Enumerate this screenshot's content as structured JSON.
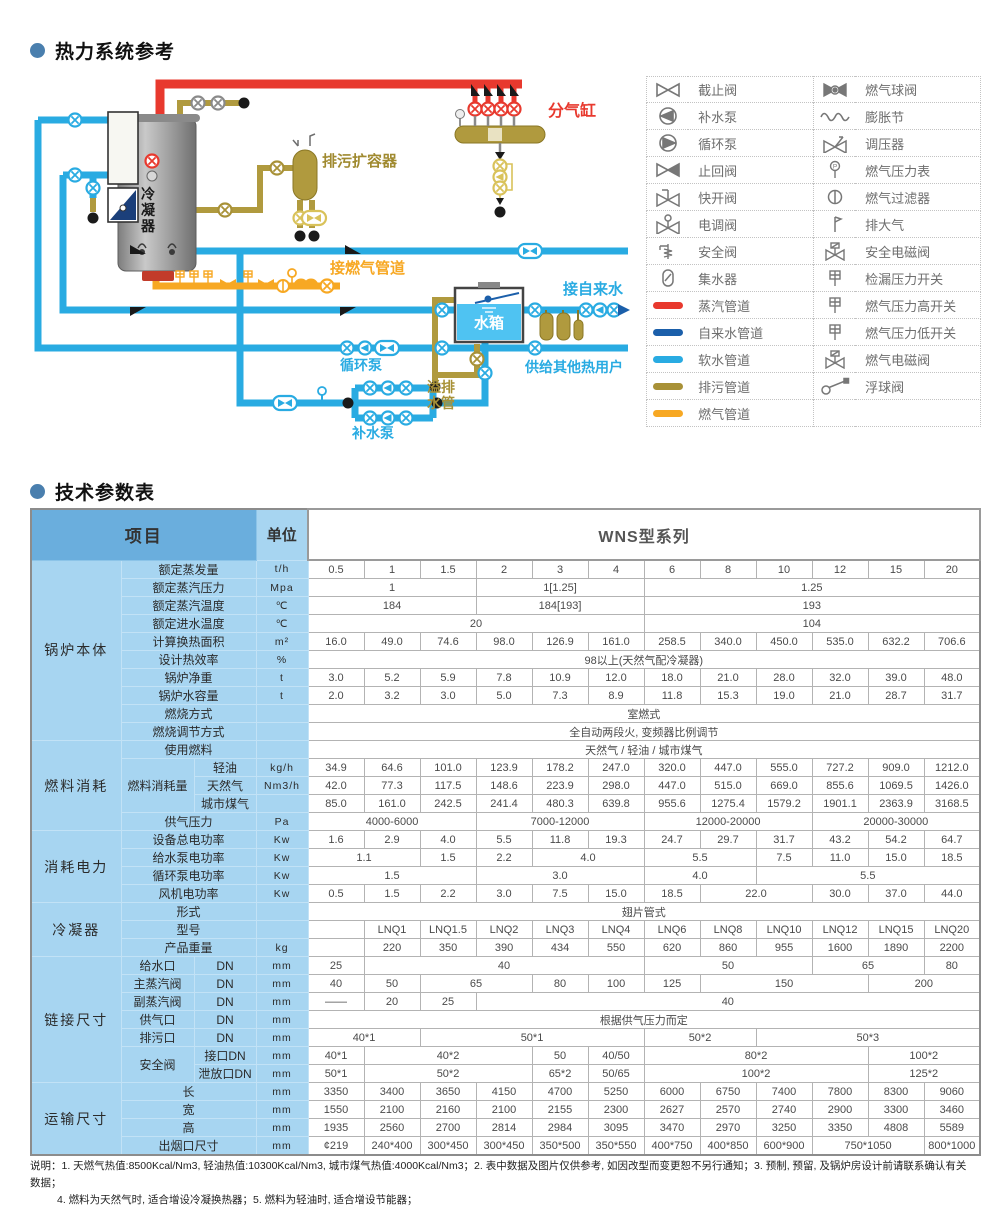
{
  "section_thermal": {
    "title": "热力系统参考"
  },
  "section_params": {
    "title": "技术参数表"
  },
  "diagram": {
    "labels": {
      "condenser": "冷凝器",
      "blowdown_vessel": "排污扩容器",
      "steam_header": "分气缸",
      "gas_pipe": "接燃气管道",
      "tap_water": "接自来水",
      "overflow_pipe": "溢排水管",
      "water_tank": "水箱",
      "circulation_pump": "循环泵",
      "makeup_pump": "补水泵",
      "other_users": "供给其他热用户"
    },
    "colors": {
      "steam": "#E8392E",
      "tap_water": "#1B5FAA",
      "soft_water": "#29ABE2",
      "blowdown": "#A89137",
      "gas": "#F7A823"
    }
  },
  "legend": {
    "left": [
      {
        "icon": "gate-valve",
        "label": "截止阀"
      },
      {
        "icon": "makeup-pump",
        "label": "补水泵"
      },
      {
        "icon": "circulation-pump",
        "label": "循环泵"
      },
      {
        "icon": "check-valve",
        "label": "止回阀"
      },
      {
        "icon": "quick-open-valve",
        "label": "快开阀"
      },
      {
        "icon": "electric-valve",
        "label": "电调阀"
      },
      {
        "icon": "safety-valve",
        "label": "安全阀"
      },
      {
        "icon": "water-collector",
        "label": "集水器"
      },
      {
        "icon": "steam-pipe",
        "label": "蒸汽管道",
        "color": "#E8392E"
      },
      {
        "icon": "tap-water-pipe",
        "label": "自来水管道",
        "color": "#1B5FAA"
      },
      {
        "icon": "soft-water-pipe",
        "label": "软水管道",
        "color": "#29ABE2"
      },
      {
        "icon": "blowdown-pipe",
        "label": "排污管道",
        "color": "#A89137"
      },
      {
        "icon": "gas-pipe",
        "label": "燃气管道",
        "color": "#F7A823"
      }
    ],
    "right": [
      {
        "icon": "gas-ball-valve",
        "label": "燃气球阀"
      },
      {
        "icon": "expansion-joint",
        "label": "膨胀节"
      },
      {
        "icon": "pressure-regulator",
        "label": "调压器"
      },
      {
        "icon": "gas-pressure-gauge",
        "label": "燃气压力表"
      },
      {
        "icon": "gas-filter",
        "label": "燃气过滤器"
      },
      {
        "icon": "vent",
        "label": "排大气"
      },
      {
        "icon": "safety-solenoid-valve",
        "label": "安全电磁阀"
      },
      {
        "icon": "leak-pressure-switch",
        "label": "检漏压力开关"
      },
      {
        "icon": "gas-pressure-high-switch",
        "label": "燃气压力高开关"
      },
      {
        "icon": "gas-pressure-low-switch",
        "label": "燃气压力低开关"
      },
      {
        "icon": "gas-solenoid-valve",
        "label": "燃气电磁阀"
      },
      {
        "icon": "float-valve",
        "label": "浮球阀"
      }
    ]
  },
  "table": {
    "header": {
      "item": "项目",
      "unit": "单位",
      "series": "WNS型系列"
    },
    "rows": [
      {
        "c": "锅炉本体",
        "cr": 10,
        "l": "额定蒸发量",
        "u": "t/h",
        "v": [
          "0.5",
          "1",
          "1.5",
          "2",
          "3",
          "4",
          "6",
          "8",
          "10",
          "12",
          "15",
          "20"
        ]
      },
      {
        "l": "额定蒸汽压力",
        "u": "Mpa",
        "v": [
          [
            "1",
            3
          ],
          [
            "1[1.25]",
            3
          ],
          [
            "1.25",
            6
          ]
        ]
      },
      {
        "l": "额定蒸汽温度",
        "u": "℃",
        "v": [
          [
            "184",
            3
          ],
          [
            "184[193]",
            3
          ],
          [
            "193",
            6
          ]
        ]
      },
      {
        "l": "额定进水温度",
        "u": "℃",
        "v": [
          [
            "20",
            6
          ],
          [
            "104",
            6
          ]
        ]
      },
      {
        "l": "计算换热面积",
        "u": "m²",
        "v": [
          "16.0",
          "49.0",
          "74.6",
          "98.0",
          "126.9",
          "161.0",
          "258.5",
          "340.0",
          "450.0",
          "535.0",
          "632.2",
          "706.6"
        ]
      },
      {
        "l": "设计热效率",
        "u": "%",
        "v": [
          [
            "98以上(天然气配冷凝器)",
            12
          ]
        ]
      },
      {
        "l": "锅炉净重",
        "u": "t",
        "v": [
          "3.0",
          "5.2",
          "5.9",
          "7.8",
          "10.9",
          "12.0",
          "18.0",
          "21.0",
          "28.0",
          "32.0",
          "39.0",
          "48.0"
        ]
      },
      {
        "l": "锅炉水容量",
        "u": "t",
        "v": [
          "2.0",
          "3.2",
          "3.0",
          "5.0",
          "7.3",
          "8.9",
          "11.8",
          "15.3",
          "19.0",
          "21.0",
          "28.7",
          "31.7"
        ]
      },
      {
        "l": "燃烧方式",
        "u": "",
        "v": [
          [
            "室燃式",
            12
          ]
        ]
      },
      {
        "l": "燃烧调节方式",
        "u": "",
        "v": [
          [
            "全自动两段火, 变频器比例调节",
            12
          ]
        ]
      },
      {
        "c": "燃料消耗",
        "cr": 5,
        "l": "使用燃料",
        "u": "",
        "v": [
          [
            "天然气 / 轻油 / 城市煤气",
            12
          ]
        ]
      },
      {
        "l": "燃料消耗量",
        "lr": 3,
        "l2": "轻油",
        "u": "kg/h",
        "v": [
          "34.9",
          "64.6",
          "101.0",
          "123.9",
          "178.2",
          "247.0",
          "320.0",
          "447.0",
          "555.0",
          "727.2",
          "909.0",
          "1212.0"
        ]
      },
      {
        "l2": "天然气",
        "u": "Nm3/h",
        "v": [
          "42.0",
          "77.3",
          "117.5",
          "148.6",
          "223.9",
          "298.0",
          "447.0",
          "515.0",
          "669.0",
          "855.6",
          "1069.5",
          "1426.0"
        ]
      },
      {
        "l2": "城市煤气",
        "u": "",
        "v": [
          "85.0",
          "161.0",
          "242.5",
          "241.4",
          "480.3",
          "639.8",
          "955.6",
          "1275.4",
          "1579.2",
          "1901.1",
          "2363.9",
          "3168.5"
        ]
      },
      {
        "l": "供气压力",
        "u": "Pa",
        "v": [
          [
            "4000-6000",
            3
          ],
          [
            "7000-12000",
            3
          ],
          [
            "12000-20000",
            3
          ],
          [
            "20000-30000",
            3
          ]
        ]
      },
      {
        "c": "消耗电力",
        "cr": 4,
        "l": "设备总电功率",
        "u": "Kw",
        "v": [
          "1.6",
          "2.9",
          "4.0",
          "5.5",
          "11.8",
          "19.3",
          "24.7",
          "29.7",
          "31.7",
          "43.2",
          "54.2",
          "64.7"
        ]
      },
      {
        "l": "给水泵电功率",
        "u": "Kw",
        "v": [
          [
            "1.1",
            2
          ],
          "1.5",
          "2.2",
          [
            "4.0",
            2
          ],
          [
            "5.5",
            2
          ],
          "7.5",
          "11.0",
          "15.0",
          "18.5"
        ]
      },
      {
        "l": "循环泵电功率",
        "u": "Kw",
        "v": [
          [
            "1.5",
            3
          ],
          [
            "3.0",
            3
          ],
          [
            "4.0",
            2
          ],
          [
            "5.5",
            4
          ]
        ]
      },
      {
        "l": "风机电功率",
        "u": "Kw",
        "v": [
          "0.5",
          "1.5",
          "2.2",
          "3.0",
          "7.5",
          "15.0",
          "18.5",
          [
            "22.0",
            2
          ],
          "30.0",
          "37.0",
          "44.0"
        ]
      },
      {
        "c": "冷凝器",
        "cr": 3,
        "l": "形式",
        "u": "",
        "v": [
          [
            "翅片管式",
            12
          ]
        ]
      },
      {
        "l": "型号",
        "u": "",
        "v": [
          "",
          "LNQ1",
          "LNQ1.5",
          "LNQ2",
          "LNQ3",
          "LNQ4",
          "LNQ6",
          "LNQ8",
          "LNQ10",
          "LNQ12",
          "LNQ15",
          "LNQ20"
        ]
      },
      {
        "l": "产品重量",
        "u": "kg",
        "v": [
          "",
          "220",
          "350",
          "390",
          "434",
          "550",
          "620",
          "860",
          "955",
          "1600",
          "1890",
          "2200"
        ]
      },
      {
        "c": "链接尺寸",
        "cr": 7,
        "l": "给水口",
        "l2": "DN",
        "u": "mm",
        "v": [
          "25",
          [
            "40",
            5
          ],
          [
            "50",
            3
          ],
          [
            "65",
            2
          ],
          "80"
        ]
      },
      {
        "l": "主蒸汽阀",
        "l2": "DN",
        "u": "mm",
        "v": [
          "40",
          "50",
          [
            "65",
            2
          ],
          "80",
          "100",
          "125",
          [
            "150",
            3
          ],
          [
            "200",
            2
          ]
        ]
      },
      {
        "l": "副蒸汽阀",
        "l2": "DN",
        "u": "mm",
        "v": [
          "——",
          "20",
          "25",
          [
            "40",
            9
          ]
        ]
      },
      {
        "l": "供气口",
        "l2": "DN",
        "u": "mm",
        "v": [
          [
            "根据供气压力而定",
            12
          ]
        ]
      },
      {
        "l": "排污口",
        "l2": "DN",
        "u": "mm",
        "v": [
          [
            "40*1",
            2
          ],
          [
            "50*1",
            4
          ],
          [
            "50*2",
            2
          ],
          [
            "50*3",
            4
          ]
        ]
      },
      {
        "l": "安全阀",
        "lr": 2,
        "l2": "接口DN",
        "u": "mm",
        "v": [
          "40*1",
          [
            "40*2",
            3
          ],
          "50",
          "40/50",
          [
            "80*2",
            4
          ],
          [
            "100*2",
            2
          ]
        ]
      },
      {
        "l2": "泄放口DN",
        "u": "mm",
        "v": [
          "50*1",
          [
            "50*2",
            3
          ],
          "65*2",
          "50/65",
          [
            "100*2",
            4
          ],
          [
            "125*2",
            2
          ]
        ]
      },
      {
        "c": "运输尺寸",
        "cr": 4,
        "l": "长",
        "u": "mm",
        "v": [
          "3350",
          "3400",
          "3650",
          "4150",
          "4700",
          "5250",
          "6000",
          "6750",
          "7400",
          "7800",
          "8300",
          "9060"
        ]
      },
      {
        "l": "宽",
        "u": "mm",
        "v": [
          "1550",
          "2100",
          "2160",
          "2100",
          "2155",
          "2300",
          "2627",
          "2570",
          "2740",
          "2900",
          "3300",
          "3460"
        ]
      },
      {
        "l": "高",
        "u": "mm",
        "v": [
          "1935",
          "2560",
          "2700",
          "2814",
          "2984",
          "3095",
          "3470",
          "2970",
          "3250",
          "3350",
          "4808",
          "5589"
        ]
      },
      {
        "l": "出烟口尺寸",
        "u": "mm",
        "v": [
          "¢219",
          "240*400",
          "300*450",
          "300*450",
          "350*500",
          "350*550",
          "400*750",
          "400*850",
          "600*900",
          [
            "750*1050",
            2
          ],
          "800*1000"
        ]
      }
    ]
  },
  "notes": {
    "lines": [
      "说明：1. 天燃气热值:8500Kcal/Nm3, 轻油热值:10300Kcal/Nm3, 城市煤气热值:4000Kcal/Nm3；2. 表中数据及图片仅供参考, 如因改型而变更恕不另行通知；3. 预制, 预留, 及锅炉房设计前请联系确认有关数据；",
      "4. 燃料为天然气时, 适合增设冷凝换热器；5. 燃料为轻油时, 适合增设节能器；"
    ]
  }
}
